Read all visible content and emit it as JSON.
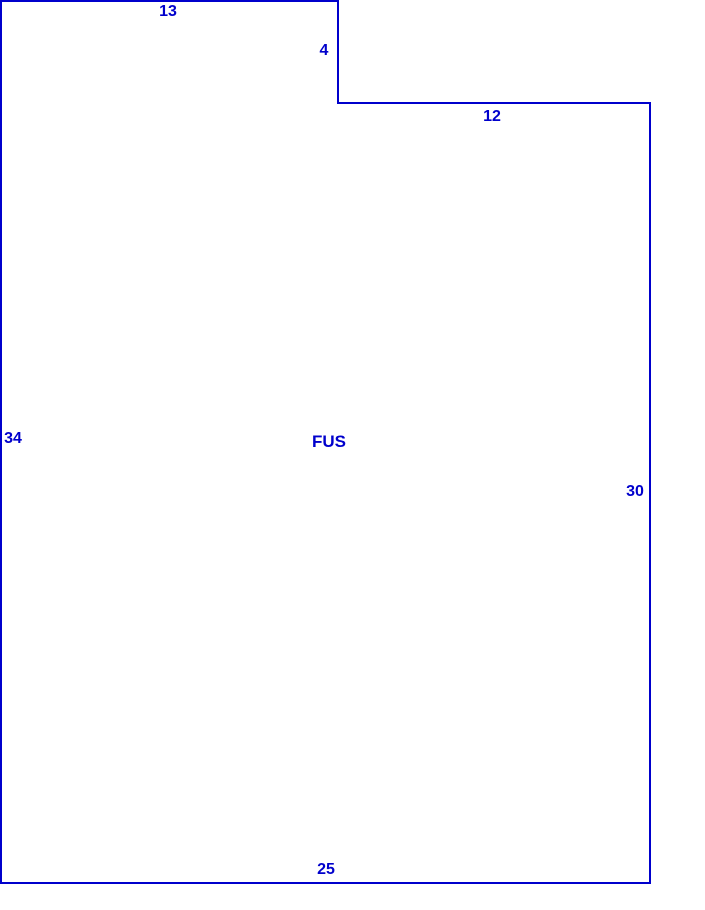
{
  "sketch": {
    "area_label": "FUS",
    "line_color": "#0000CC",
    "text_color": "#0000CC",
    "polygon": {
      "vertices": [
        [
          1,
          1
        ],
        [
          338,
          1
        ],
        [
          338,
          103
        ],
        [
          650,
          103
        ],
        [
          650,
          883
        ],
        [
          1,
          883
        ]
      ]
    },
    "dimensions": {
      "top": "13",
      "step": "4",
      "upper_top": "12",
      "left": "34",
      "right": "30",
      "bottom": "25"
    }
  }
}
